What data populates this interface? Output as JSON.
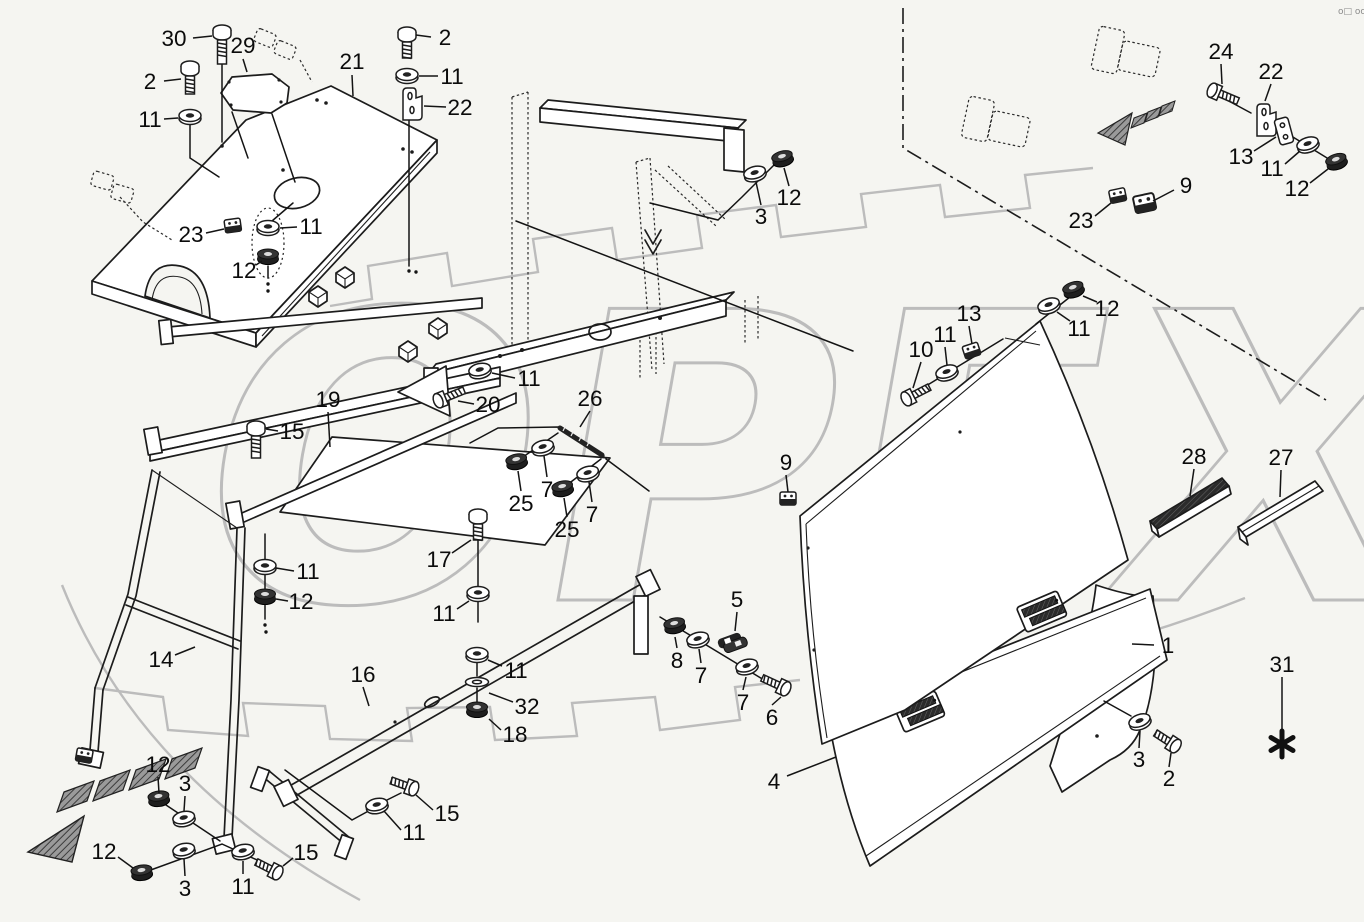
{
  "page": {
    "background_color": "#f5f5f1",
    "corner_mark": "o□ ooo"
  },
  "watermark": {
    "text": "OPEX",
    "color": "#bcbcbc"
  },
  "footnote_symbol": "✱",
  "callouts": [
    {
      "part": "30",
      "x": 174,
      "y": 38,
      "leader": [
        [
          193,
          38
        ],
        [
          212,
          36
        ]
      ]
    },
    {
      "part": "29",
      "x": 243,
      "y": 45,
      "leader": [
        [
          243,
          59
        ],
        [
          247,
          72
        ]
      ]
    },
    {
      "part": "2",
      "x": 150,
      "y": 81,
      "leader": [
        [
          164,
          81
        ],
        [
          181,
          79
        ]
      ]
    },
    {
      "part": "11",
      "x": 150,
      "y": 119,
      "leader": [
        [
          164,
          119
        ],
        [
          178,
          118
        ]
      ]
    },
    {
      "part": "21",
      "x": 352,
      "y": 61,
      "leader": [
        [
          352,
          75
        ],
        [
          353,
          96
        ]
      ]
    },
    {
      "part": "2",
      "x": 445,
      "y": 37,
      "leader": [
        [
          431,
          37
        ],
        [
          416,
          35
        ]
      ]
    },
    {
      "part": "11",
      "x": 452,
      "y": 76,
      "leader": [
        [
          438,
          76
        ],
        [
          419,
          76
        ]
      ]
    },
    {
      "part": "22",
      "x": 460,
      "y": 107,
      "leader": [
        [
          446,
          107
        ],
        [
          424,
          106
        ]
      ]
    },
    {
      "part": "23",
      "x": 191,
      "y": 234,
      "leader": [
        [
          206,
          233
        ],
        [
          224,
          229
        ]
      ]
    },
    {
      "part": "11",
      "x": 311,
      "y": 226,
      "leader": [
        [
          297,
          227
        ],
        [
          280,
          228
        ]
      ]
    },
    {
      "part": "12",
      "x": 244,
      "y": 270,
      "leader": [
        [
          256,
          265
        ],
        [
          262,
          261
        ]
      ]
    },
    {
      "part": "3",
      "x": 761,
      "y": 216,
      "leader": [
        [
          761,
          205
        ],
        [
          756,
          182
        ]
      ]
    },
    {
      "part": "12",
      "x": 789,
      "y": 197,
      "leader": [
        [
          789,
          186
        ],
        [
          784,
          168
        ]
      ]
    },
    {
      "part": "24",
      "x": 1221,
      "y": 51,
      "leader": [
        [
          1221,
          64
        ],
        [
          1222,
          84
        ]
      ]
    },
    {
      "part": "22",
      "x": 1271,
      "y": 71,
      "leader": [
        [
          1271,
          84
        ],
        [
          1265,
          101
        ]
      ]
    },
    {
      "part": "13",
      "x": 1241,
      "y": 156,
      "leader": [
        [
          1254,
          151
        ],
        [
          1276,
          137
        ]
      ]
    },
    {
      "part": "11",
      "x": 1272,
      "y": 168,
      "leader": [
        [
          1285,
          164
        ],
        [
          1300,
          151
        ]
      ]
    },
    {
      "part": "12",
      "x": 1297,
      "y": 188,
      "leader": [
        [
          1310,
          183
        ],
        [
          1328,
          169
        ]
      ]
    },
    {
      "part": "9",
      "x": 1186,
      "y": 185,
      "leader": [
        [
          1174,
          190
        ],
        [
          1153,
          201
        ]
      ]
    },
    {
      "part": "23",
      "x": 1081,
      "y": 220,
      "leader": [
        [
          1095,
          216
        ],
        [
          1111,
          203
        ]
      ]
    },
    {
      "part": "10",
      "x": 921,
      "y": 349,
      "leader": [
        [
          921,
          362
        ],
        [
          913,
          388
        ]
      ]
    },
    {
      "part": "11",
      "x": 945,
      "y": 334,
      "leader": [
        [
          945,
          347
        ],
        [
          947,
          365
        ]
      ]
    },
    {
      "part": "13",
      "x": 969,
      "y": 313,
      "leader": [
        [
          969,
          326
        ],
        [
          972,
          344
        ]
      ]
    },
    {
      "part": "11",
      "x": 1079,
      "y": 328,
      "leader": [
        [
          1070,
          321
        ],
        [
          1057,
          312
        ]
      ]
    },
    {
      "part": "12",
      "x": 1107,
      "y": 308,
      "leader": [
        [
          1097,
          302
        ],
        [
          1083,
          296
        ]
      ]
    },
    {
      "part": "9",
      "x": 786,
      "y": 462,
      "leader": [
        [
          786,
          475
        ],
        [
          788,
          492
        ]
      ]
    },
    {
      "part": "28",
      "x": 1194,
      "y": 456,
      "leader": [
        [
          1194,
          469
        ],
        [
          1190,
          496
        ]
      ]
    },
    {
      "part": "27",
      "x": 1281,
      "y": 457,
      "leader": [
        [
          1281,
          470
        ],
        [
          1280,
          497
        ]
      ]
    },
    {
      "part": "1",
      "x": 1168,
      "y": 645,
      "leader": [
        [
          1154,
          645
        ],
        [
          1132,
          644
        ]
      ]
    },
    {
      "part": "31",
      "x": 1282,
      "y": 664,
      "leader": [
        [
          1282,
          677
        ],
        [
          1282,
          729
        ]
      ]
    },
    {
      "part": "3",
      "x": 1139,
      "y": 759,
      "leader": [
        [
          1139,
          748
        ],
        [
          1140,
          731
        ]
      ]
    },
    {
      "part": "2",
      "x": 1169,
      "y": 778,
      "leader": [
        [
          1169,
          767
        ],
        [
          1171,
          753
        ]
      ]
    },
    {
      "part": "4",
      "x": 774,
      "y": 781,
      "leader": [
        [
          787,
          776
        ],
        [
          836,
          757
        ]
      ]
    },
    {
      "part": "19",
      "x": 328,
      "y": 399,
      "leader": [
        [
          328,
          412
        ],
        [
          330,
          447
        ]
      ]
    },
    {
      "part": "15",
      "x": 292,
      "y": 431,
      "leader": [
        [
          278,
          431
        ],
        [
          266,
          429
        ]
      ]
    },
    {
      "part": "20",
      "x": 488,
      "y": 404,
      "leader": [
        [
          474,
          404
        ],
        [
          458,
          401
        ]
      ]
    },
    {
      "part": "11",
      "x": 529,
      "y": 378,
      "leader": [
        [
          515,
          378
        ],
        [
          492,
          373
        ]
      ]
    },
    {
      "part": "26",
      "x": 590,
      "y": 398,
      "leader": [
        [
          590,
          411
        ],
        [
          580,
          427
        ]
      ]
    },
    {
      "part": "25",
      "x": 521,
      "y": 503,
      "leader": [
        [
          521,
          491
        ],
        [
          518,
          471
        ]
      ]
    },
    {
      "part": "7",
      "x": 547,
      "y": 489,
      "leader": [
        [
          547,
          477
        ],
        [
          544,
          456
        ]
      ]
    },
    {
      "part": "25",
      "x": 567,
      "y": 529,
      "leader": [
        [
          567,
          517
        ],
        [
          564,
          498
        ]
      ]
    },
    {
      "part": "7",
      "x": 592,
      "y": 514,
      "leader": [
        [
          592,
          502
        ],
        [
          589,
          482
        ]
      ]
    },
    {
      "part": "17",
      "x": 439,
      "y": 559,
      "leader": [
        [
          452,
          553
        ],
        [
          471,
          540
        ]
      ]
    },
    {
      "part": "11",
      "x": 444,
      "y": 613,
      "leader": [
        [
          457,
          609
        ],
        [
          469,
          601
        ]
      ]
    },
    {
      "part": "11",
      "x": 516,
      "y": 670,
      "leader": [
        [
          502,
          666
        ],
        [
          488,
          660
        ]
      ]
    },
    {
      "part": "32",
      "x": 527,
      "y": 706,
      "leader": [
        [
          513,
          702
        ],
        [
          489,
          693
        ]
      ]
    },
    {
      "part": "18",
      "x": 515,
      "y": 734,
      "leader": [
        [
          501,
          730
        ],
        [
          489,
          719
        ]
      ]
    },
    {
      "part": "12",
      "x": 301,
      "y": 601,
      "leader": [
        [
          288,
          601
        ],
        [
          276,
          599
        ]
      ]
    },
    {
      "part": "11",
      "x": 308,
      "y": 571,
      "leader": [
        [
          294,
          571
        ],
        [
          276,
          568
        ]
      ]
    },
    {
      "part": "14",
      "x": 161,
      "y": 659,
      "leader": [
        [
          175,
          655
        ],
        [
          195,
          647
        ]
      ]
    },
    {
      "part": "16",
      "x": 363,
      "y": 674,
      "leader": [
        [
          363,
          687
        ],
        [
          369,
          706
        ]
      ]
    },
    {
      "part": "5",
      "x": 737,
      "y": 599,
      "leader": [
        [
          737,
          612
        ],
        [
          735,
          631
        ]
      ]
    },
    {
      "part": "8",
      "x": 677,
      "y": 660,
      "leader": [
        [
          677,
          648
        ],
        [
          675,
          637
        ]
      ]
    },
    {
      "part": "7",
      "x": 701,
      "y": 675,
      "leader": [
        [
          701,
          663
        ],
        [
          699,
          649
        ]
      ]
    },
    {
      "part": "7",
      "x": 743,
      "y": 702,
      "leader": [
        [
          743,
          690
        ],
        [
          746,
          677
        ]
      ]
    },
    {
      "part": "6",
      "x": 772,
      "y": 717,
      "leader": [
        [
          772,
          705
        ],
        [
          781,
          697
        ]
      ]
    },
    {
      "part": "12",
      "x": 158,
      "y": 764,
      "leader": [
        [
          158,
          777
        ],
        [
          159,
          793
        ]
      ]
    },
    {
      "part": "3",
      "x": 185,
      "y": 783,
      "leader": [
        [
          185,
          796
        ],
        [
          184,
          811
        ]
      ]
    },
    {
      "part": "12",
      "x": 104,
      "y": 851,
      "leader": [
        [
          118,
          857
        ],
        [
          133,
          868
        ]
      ]
    },
    {
      "part": "3",
      "x": 185,
      "y": 888,
      "leader": [
        [
          185,
          876
        ],
        [
          184,
          859
        ]
      ]
    },
    {
      "part": "11",
      "x": 243,
      "y": 886,
      "leader": [
        [
          243,
          874
        ],
        [
          243,
          861
        ]
      ]
    },
    {
      "part": "15",
      "x": 306,
      "y": 852,
      "leader": [
        [
          293,
          858
        ],
        [
          283,
          866
        ]
      ]
    },
    {
      "part": "15",
      "x": 447,
      "y": 813,
      "leader": [
        [
          433,
          810
        ],
        [
          416,
          795
        ]
      ]
    },
    {
      "part": "11",
      "x": 414,
      "y": 832,
      "leader": [
        [
          401,
          830
        ],
        [
          384,
          811
        ]
      ]
    }
  ]
}
